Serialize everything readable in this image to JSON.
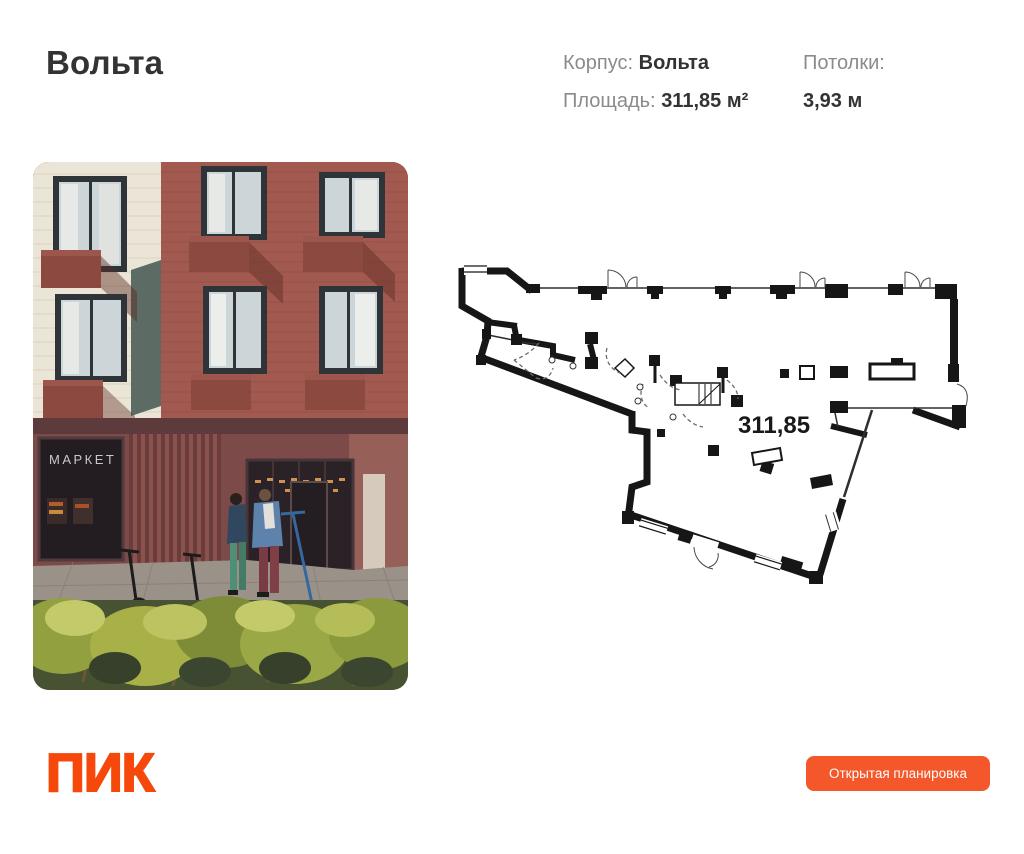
{
  "header": {
    "title": "Вольта",
    "specs": {
      "building": {
        "label": "Корпус:",
        "value": "Вольта"
      },
      "area": {
        "label": "Площадь:",
        "value": "311,85 м²"
      },
      "ceiling": {
        "label": "Потолки:",
        "value": "3,93 м"
      }
    }
  },
  "photo": {
    "storefront_sign": "МАРКЕТ"
  },
  "plan": {
    "area_label": "311,85"
  },
  "footer": {
    "logo_text": "ПИК",
    "button_label": "Открытая планировка"
  },
  "colors": {
    "background": "#ffffff",
    "text_dark": "#333333",
    "text_gray": "#8b8b8b",
    "logo_orange": "#f6480b",
    "button_orange": "#f4572a",
    "plan_line": "#161616",
    "facade_brick_red": "#a2594f",
    "facade_brick_cream": "#eae5d6"
  }
}
